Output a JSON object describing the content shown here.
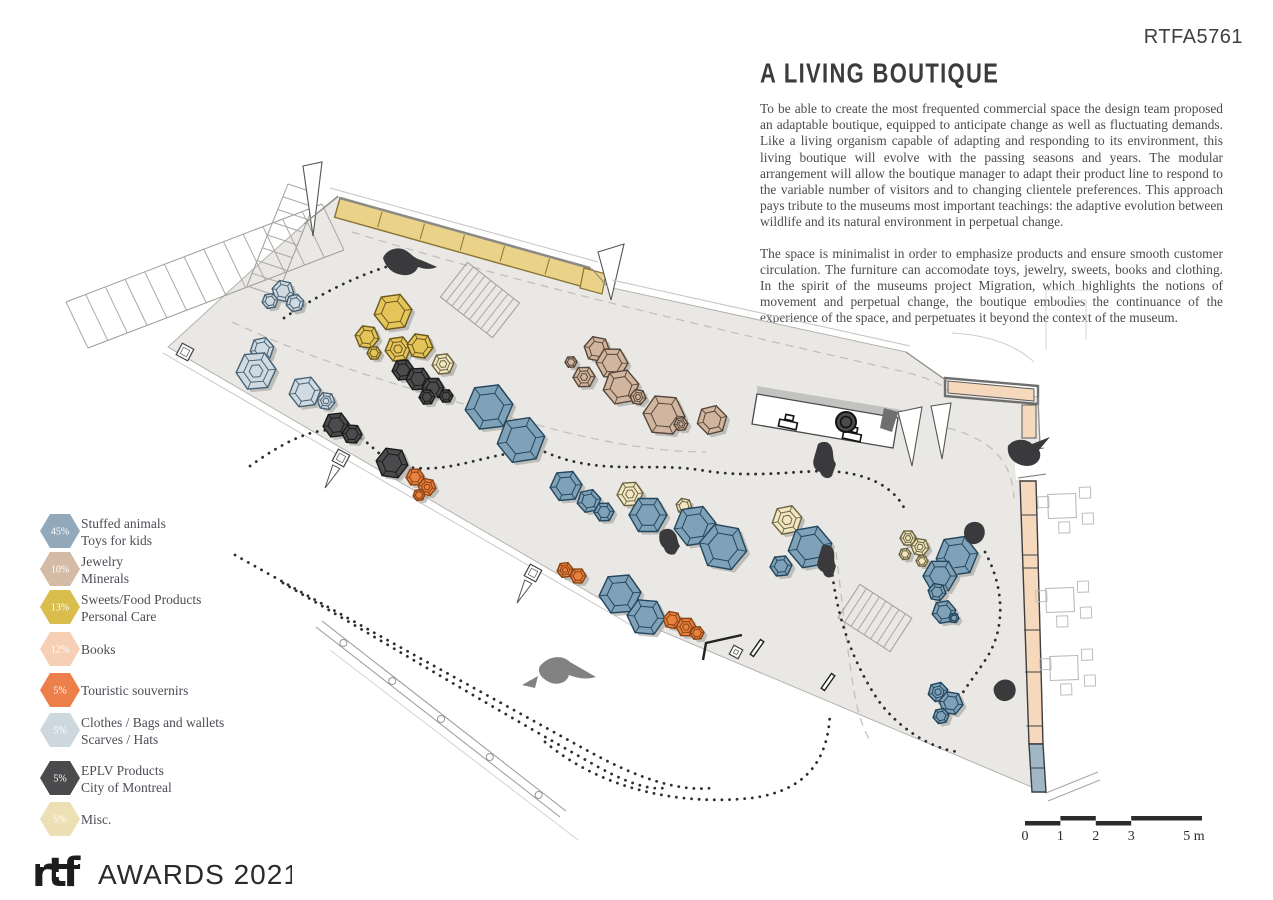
{
  "page": {
    "ref_code": "RTFA5761"
  },
  "article": {
    "title": "A LIVING BOUTIQUE",
    "paragraphs": [
      "To be able to create the most frequented commercial space the design team proposed an adaptable boutique, equipped to anticipate change as well as fluctuating demands. Like a living organism capable of adapting and responding to its environment, this living boutique will evolve with the passing seasons and years. The modular arrangement will allow the boutique manager to adapt their product line to respond to the variable number of visitors and to changing clientele preferences. This approach pays tribute to the museums most important teachings: the adaptive evolution between wildlife and its natural environment in perpetual change.",
      "The space is minimalist in order to emphasize products and ensure smooth customer circulation. The furniture can accomodate toys, jewelry, sweets, books and clothing. In the spirit of the museums project Migration, which highlights the notions of movement and perpetual change, the boutique embodies the continuance of the experience of the space, and perpetuates it beyond the context of the museum."
    ]
  },
  "legend": {
    "items": [
      {
        "pct": "45%",
        "color": "#92a9bc",
        "lines": [
          "Stuffed animals",
          "Toys for kids"
        ]
      },
      {
        "pct": "10%",
        "color": "#d3bba6",
        "lines": [
          "Jewelry",
          "Minerals"
        ]
      },
      {
        "pct": "13%",
        "color": "#d9bd4d",
        "lines": [
          "Sweets/Food Products",
          "Personal Care"
        ]
      },
      {
        "pct": "12%",
        "color": "#f6cfb5",
        "lines": [
          "Books"
        ]
      },
      {
        "pct": "5%",
        "color": "#ec7f4a",
        "lines": [
          "Touristic souvernirs"
        ]
      },
      {
        "pct": "5%",
        "color": "#ccd7de",
        "lines": [
          "Clothes / Bags and wallets",
          "Scarves / Hats"
        ]
      },
      {
        "pct": "5%",
        "color": "#4b4b4d",
        "lines": [
          "EPLV Products",
          "City of Montreal"
        ]
      },
      {
        "pct": "5%",
        "color": "#ece0b4",
        "lines": [
          "Misc."
        ]
      }
    ]
  },
  "scalebar": {
    "labels": [
      "0",
      "1",
      "2",
      "3",
      "5 m"
    ]
  },
  "footer": {
    "logo_mark": "rtf",
    "logo_text": "AWARDS 2021"
  },
  "plan": {
    "hex_styles": {
      "blue": {
        "f": "#7fa2b8",
        "s": "#24465c"
      },
      "lightblue": {
        "f": "#cfdae2",
        "s": "#4a6273"
      },
      "yellow": {
        "f": "#e5c459",
        "s": "#6a581f"
      },
      "tan": {
        "f": "#d1b59e",
        "s": "#56463a"
      },
      "orange": {
        "f": "#e9813f",
        "s": "#8a4413"
      },
      "cream": {
        "f": "#f2e7c2",
        "s": "#6c6441"
      },
      "dark": {
        "f": "#4b4b4d",
        "s": "#1b1b1b"
      }
    },
    "floor": "M338,197 L592,269 L608,287 L906,352 L947,381 L1038,397 L1040,446 L1020,470 L1020,481 L1036,481 L1043,744 L1046,793 L640,622 L168,347 L250,272 L304,224 Z",
    "floor_fill": "#e9e8e5",
    "hexes": [
      {
        "x": 283,
        "y": 291,
        "r": 11,
        "c": "lightblue"
      },
      {
        "x": 270,
        "y": 301,
        "r": 8,
        "c": "lightblue"
      },
      {
        "x": 295,
        "y": 303,
        "r": 9,
        "c": "lightblue"
      },
      {
        "x": 262,
        "y": 349,
        "r": 12,
        "c": "lightblue"
      },
      {
        "x": 256,
        "y": 371,
        "r": 20,
        "c": "lightblue",
        "ring": true
      },
      {
        "x": 305,
        "y": 392,
        "r": 16,
        "c": "lightblue"
      },
      {
        "x": 326,
        "y": 401,
        "r": 9,
        "c": "lightblue",
        "ring": true
      },
      {
        "x": 336,
        "y": 425,
        "r": 13,
        "c": "dark"
      },
      {
        "x": 352,
        "y": 434,
        "r": 10,
        "c": "dark"
      },
      {
        "x": 393,
        "y": 312,
        "r": 19,
        "c": "yellow"
      },
      {
        "x": 367,
        "y": 337,
        "r": 12,
        "c": "yellow"
      },
      {
        "x": 398,
        "y": 349,
        "r": 13,
        "c": "yellow",
        "ring": true
      },
      {
        "x": 420,
        "y": 346,
        "r": 13,
        "c": "yellow"
      },
      {
        "x": 374,
        "y": 353,
        "r": 7,
        "c": "yellow"
      },
      {
        "x": 443,
        "y": 364,
        "r": 11,
        "c": "cream",
        "ring": true
      },
      {
        "x": 403,
        "y": 370,
        "r": 11,
        "c": "dark"
      },
      {
        "x": 418,
        "y": 379,
        "r": 12,
        "c": "dark"
      },
      {
        "x": 433,
        "y": 388,
        "r": 11,
        "c": "dark"
      },
      {
        "x": 427,
        "y": 397,
        "r": 8,
        "c": "dark"
      },
      {
        "x": 446,
        "y": 396,
        "r": 7,
        "c": "dark"
      },
      {
        "x": 571,
        "y": 362,
        "r": 6,
        "c": "tan"
      },
      {
        "x": 597,
        "y": 349,
        "r": 13,
        "c": "tan"
      },
      {
        "x": 612,
        "y": 363,
        "r": 16,
        "c": "tan"
      },
      {
        "x": 584,
        "y": 377,
        "r": 11,
        "c": "tan",
        "ring": true
      },
      {
        "x": 621,
        "y": 387,
        "r": 18,
        "c": "tan"
      },
      {
        "x": 638,
        "y": 397,
        "r": 8,
        "c": "tan",
        "ring": true
      },
      {
        "x": 664,
        "y": 415,
        "r": 21,
        "c": "tan"
      },
      {
        "x": 681,
        "y": 424,
        "r": 7,
        "c": "tan",
        "ring": true
      },
      {
        "x": 712,
        "y": 420,
        "r": 15,
        "c": "tan"
      },
      {
        "x": 489,
        "y": 407,
        "r": 24,
        "c": "blue"
      },
      {
        "x": 521,
        "y": 440,
        "r": 24,
        "c": "blue"
      },
      {
        "x": 392,
        "y": 463,
        "r": 16,
        "c": "dark"
      },
      {
        "x": 415,
        "y": 477,
        "r": 9,
        "c": "orange"
      },
      {
        "x": 427,
        "y": 487,
        "r": 9,
        "c": "orange",
        "ring": true
      },
      {
        "x": 419,
        "y": 495,
        "r": 6,
        "c": "orange"
      },
      {
        "x": 566,
        "y": 486,
        "r": 16,
        "c": "blue"
      },
      {
        "x": 589,
        "y": 501,
        "r": 12,
        "c": "blue"
      },
      {
        "x": 604,
        "y": 512,
        "r": 10,
        "c": "blue"
      },
      {
        "x": 630,
        "y": 494,
        "r": 13,
        "c": "cream",
        "ring": true
      },
      {
        "x": 648,
        "y": 515,
        "r": 19,
        "c": "blue"
      },
      {
        "x": 684,
        "y": 506,
        "r": 8,
        "c": "cream"
      },
      {
        "x": 695,
        "y": 526,
        "r": 21,
        "c": "blue"
      },
      {
        "x": 723,
        "y": 547,
        "r": 24,
        "c": "blue"
      },
      {
        "x": 565,
        "y": 570,
        "r": 8,
        "c": "orange",
        "ring": true
      },
      {
        "x": 578,
        "y": 576,
        "r": 8,
        "c": "orange"
      },
      {
        "x": 620,
        "y": 594,
        "r": 21,
        "c": "blue"
      },
      {
        "x": 646,
        "y": 617,
        "r": 19,
        "c": "blue"
      },
      {
        "x": 672,
        "y": 620,
        "r": 9,
        "c": "orange"
      },
      {
        "x": 686,
        "y": 627,
        "r": 10,
        "c": "orange",
        "ring": true
      },
      {
        "x": 697,
        "y": 633,
        "r": 7,
        "c": "orange"
      },
      {
        "x": 787,
        "y": 520,
        "r": 15,
        "c": "cream",
        "ring": true
      },
      {
        "x": 810,
        "y": 547,
        "r": 22,
        "c": "blue"
      },
      {
        "x": 781,
        "y": 566,
        "r": 11,
        "c": "blue"
      },
      {
        "x": 908,
        "y": 538,
        "r": 8,
        "c": "cream",
        "ring": true
      },
      {
        "x": 920,
        "y": 547,
        "r": 9,
        "c": "cream",
        "ring": true
      },
      {
        "x": 905,
        "y": 554,
        "r": 6,
        "c": "cream"
      },
      {
        "x": 922,
        "y": 561,
        "r": 6,
        "c": "cream"
      },
      {
        "x": 957,
        "y": 556,
        "r": 21,
        "c": "blue"
      },
      {
        "x": 940,
        "y": 576,
        "r": 17,
        "c": "blue"
      },
      {
        "x": 937,
        "y": 592,
        "r": 9,
        "c": "blue"
      },
      {
        "x": 944,
        "y": 612,
        "r": 12,
        "c": "blue"
      },
      {
        "x": 954,
        "y": 618,
        "r": 5,
        "c": "blue"
      },
      {
        "x": 938,
        "y": 692,
        "r": 10,
        "c": "blue",
        "ring": true
      },
      {
        "x": 951,
        "y": 703,
        "r": 12,
        "c": "blue"
      },
      {
        "x": 941,
        "y": 716,
        "r": 8,
        "c": "blue"
      }
    ],
    "dotted_paths": [
      "M284,318 C310,300 355,275 396,264",
      "M250,466 C292,436 322,424 350,433 C376,442 378,465 416,468 C458,472 500,448 540,452",
      "M545,452 C600,476 648,462 700,470 C758,480 806,468 840,472 C876,476 898,492 906,512",
      "M235,555 C340,614 470,686 590,752 C634,776 676,792 712,788",
      "M283,583 C380,640 500,712 600,768 C626,782 648,790 664,788",
      "M545,742 C600,788 676,806 752,798 C812,790 828,754 830,714",
      "M830,545 C832,598 846,652 878,700 C898,728 930,748 958,752",
      "M985,552 C1003,585 1006,624 989,654 C976,676 962,690 956,706"
    ],
    "dashed_paths": [
      "M352,232 C520,284 720,330 905,372 C928,378 942,384 948,391",
      "M232,322 C340,372 430,394 520,420 C610,446 668,452 706,452",
      "M948,428 C1000,442 1012,468 1014,498",
      "M836,552 C842,600 846,640 852,678 C856,708 862,728 872,744"
    ],
    "yellow_strip": {
      "fill": "#ead289",
      "stroke": "#8a7435"
    },
    "peach_fill": "#f6d9bd",
    "counter_fill": "#ffffff",
    "strip_blue": "#9fb7c6"
  }
}
